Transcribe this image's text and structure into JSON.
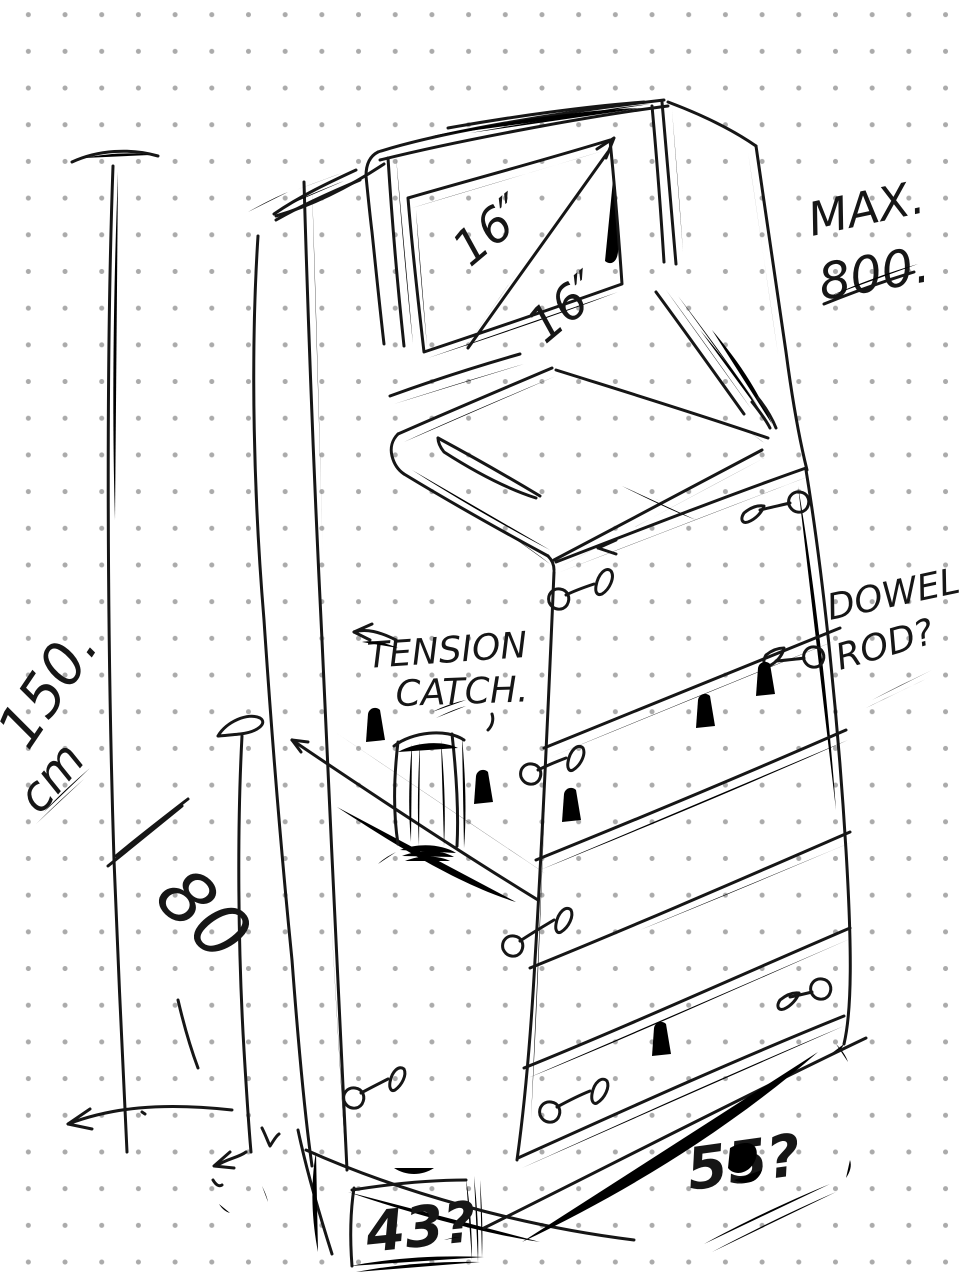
{
  "sketch": {
    "ink_color": "#161616",
    "paper_color": "#ffffff",
    "dot_color": "#ababab",
    "subject": "arcade-cabinet-concept-sketch",
    "annotations": {
      "screen_diagonal_top": "16″",
      "screen_diagonal_bottom": "16″",
      "max_weight_line1": "MAX.",
      "max_weight_line2": "800.",
      "overall_height_value": "150.",
      "overall_height_unit": "cm",
      "shelf_section_height": "80",
      "latch_label_line1": "TENSION",
      "latch_label_line2": "CATCH.",
      "dowel_note_line1": "DOWEL.",
      "dowel_note_line2": "ROD?",
      "depth_query": "55?",
      "base_width_query": "43?"
    }
  }
}
